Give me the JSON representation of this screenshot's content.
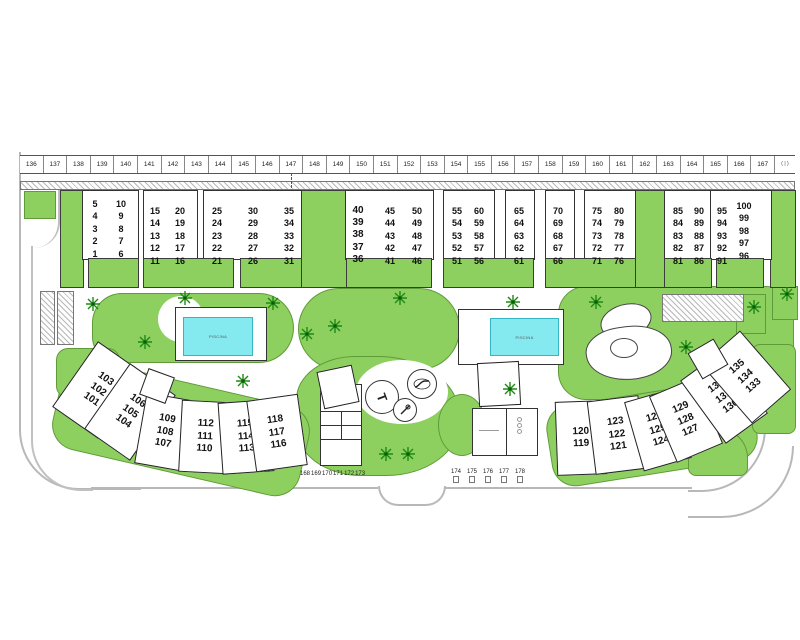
{
  "title": "residential development site plan",
  "colors": {
    "green": "#8ed05f",
    "pool_water": "#85e9f0",
    "road_line": "#b8b8b8",
    "outline": "#333333"
  },
  "ruler": {
    "numbers": [
      "136",
      "137",
      "138",
      "139",
      "140",
      "141",
      "142",
      "143",
      "144",
      "145",
      "146",
      "147",
      "148",
      "149",
      "150",
      "151",
      "152",
      "153",
      "154",
      "155",
      "156",
      "157",
      "158",
      "159",
      "160",
      "161",
      "162",
      "163",
      "164",
      "165",
      "166",
      "167"
    ],
    "end_label": "( | )"
  },
  "top_units": [
    {
      "x": 95,
      "y": 198,
      "nums": [
        "5",
        "4",
        "3",
        "2",
        "1"
      ]
    },
    {
      "x": 121,
      "y": 198,
      "nums": [
        "10",
        "9",
        "8",
        "7",
        "6"
      ]
    },
    {
      "x": 155,
      "y": 205,
      "nums": [
        "15",
        "14",
        "13",
        "12",
        "11"
      ]
    },
    {
      "x": 180,
      "y": 205,
      "nums": [
        "20",
        "19",
        "18",
        "17",
        "16"
      ]
    },
    {
      "x": 217,
      "y": 205,
      "nums": [
        "25",
        "24",
        "23",
        "22",
        "21"
      ]
    },
    {
      "x": 253,
      "y": 205,
      "nums": [
        "30",
        "29",
        "28",
        "27",
        "26"
      ]
    },
    {
      "x": 289,
      "y": 205,
      "nums": [
        "35",
        "34",
        "33",
        "32",
        "31"
      ]
    },
    {
      "x": 358,
      "y": 205,
      "bold": true,
      "nums": [
        "40",
        "39",
        "38",
        "37",
        "36"
      ]
    },
    {
      "x": 390,
      "y": 205,
      "nums": [
        "45",
        "44",
        "43",
        "42",
        "41"
      ]
    },
    {
      "x": 417,
      "y": 205,
      "nums": [
        "50",
        "49",
        "48",
        "47",
        "46"
      ]
    },
    {
      "x": 457,
      "y": 205,
      "nums": [
        "55",
        "54",
        "53",
        "52",
        "51"
      ]
    },
    {
      "x": 479,
      "y": 205,
      "nums": [
        "60",
        "59",
        "58",
        "57",
        "56"
      ]
    },
    {
      "x": 519,
      "y": 205,
      "nums": [
        "65",
        "64",
        "63",
        "62",
        "61"
      ]
    },
    {
      "x": 558,
      "y": 205,
      "nums": [
        "70",
        "69",
        "68",
        "67",
        "66"
      ]
    },
    {
      "x": 597,
      "y": 205,
      "nums": [
        "75",
        "74",
        "73",
        "72",
        "71"
      ]
    },
    {
      "x": 619,
      "y": 205,
      "nums": [
        "80",
        "79",
        "78",
        "77",
        "76"
      ]
    },
    {
      "x": 678,
      "y": 205,
      "nums": [
        "85",
        "84",
        "83",
        "82",
        "81"
      ]
    },
    {
      "x": 699,
      "y": 205,
      "nums": [
        "90",
        "89",
        "88",
        "87",
        "86"
      ]
    },
    {
      "x": 722,
      "y": 205,
      "nums": [
        "95",
        "94",
        "93",
        "92",
        "91"
      ]
    },
    {
      "x": 744,
      "y": 200,
      "nums": [
        "100",
        "99",
        "98",
        "97",
        "96"
      ]
    }
  ],
  "bottom_buildings": [
    {
      "x": 70,
      "y": 350,
      "w": 54,
      "h": 78,
      "rot": 35,
      "nums": [
        "103",
        "102",
        "101"
      ]
    },
    {
      "x": 102,
      "y": 372,
      "w": 54,
      "h": 78,
      "rot": 35,
      "nums": [
        "106",
        "105",
        "104"
      ]
    },
    {
      "x": 140,
      "y": 396,
      "w": 48,
      "h": 70,
      "rot": 10,
      "nums": [
        "109",
        "108",
        "107"
      ]
    },
    {
      "x": 180,
      "y": 401,
      "w": 48,
      "h": 70,
      "rot": 3,
      "nums": [
        "112",
        "111",
        "110"
      ]
    },
    {
      "x": 220,
      "y": 401,
      "w": 50,
      "h": 70,
      "rot": -4,
      "nums": [
        "115",
        "114",
        "113"
      ]
    },
    {
      "x": 251,
      "y": 397,
      "w": 50,
      "h": 70,
      "rot": -8,
      "nums": [
        "118",
        "117",
        "116"
      ]
    },
    {
      "x": 556,
      "y": 401,
      "w": 48,
      "h": 72,
      "rot": -2,
      "nums": [
        "120",
        "119"
      ]
    },
    {
      "x": 591,
      "y": 398,
      "w": 50,
      "h": 72,
      "rot": -7,
      "nums": [
        "123",
        "122",
        "121"
      ]
    },
    {
      "x": 633,
      "y": 394,
      "w": 48,
      "h": 70,
      "rot": -16,
      "nums": [
        "126",
        "125",
        "124"
      ]
    },
    {
      "x": 661,
      "y": 384,
      "w": 48,
      "h": 70,
      "rot": -23,
      "nums": [
        "129",
        "128",
        "127"
      ]
    },
    {
      "x": 698,
      "y": 358,
      "w": 50,
      "h": 76,
      "rot": -36,
      "nums": [
        "132",
        "131",
        "130"
      ]
    },
    {
      "x": 720,
      "y": 338,
      "w": 50,
      "h": 76,
      "rot": -41,
      "nums": [
        "135",
        "134",
        "133"
      ]
    }
  ],
  "amenities": {
    "pool_label": "PISCINA"
  },
  "bottom_labels": {
    "curb": [
      "168",
      "169",
      "170",
      "171",
      "172",
      "173"
    ],
    "spots": [
      "174",
      "175",
      "176",
      "177",
      "178"
    ]
  },
  "palms": [
    [
      85,
      296
    ],
    [
      137,
      334
    ],
    [
      177,
      290
    ],
    [
      265,
      295
    ],
    [
      299,
      326
    ],
    [
      327,
      318
    ],
    [
      392,
      290
    ],
    [
      235,
      373
    ],
    [
      378,
      446
    ],
    [
      400,
      446
    ],
    [
      502,
      381
    ],
    [
      505,
      294
    ],
    [
      588,
      294
    ],
    [
      678,
      339
    ],
    [
      746,
      299
    ],
    [
      779,
      286
    ]
  ]
}
